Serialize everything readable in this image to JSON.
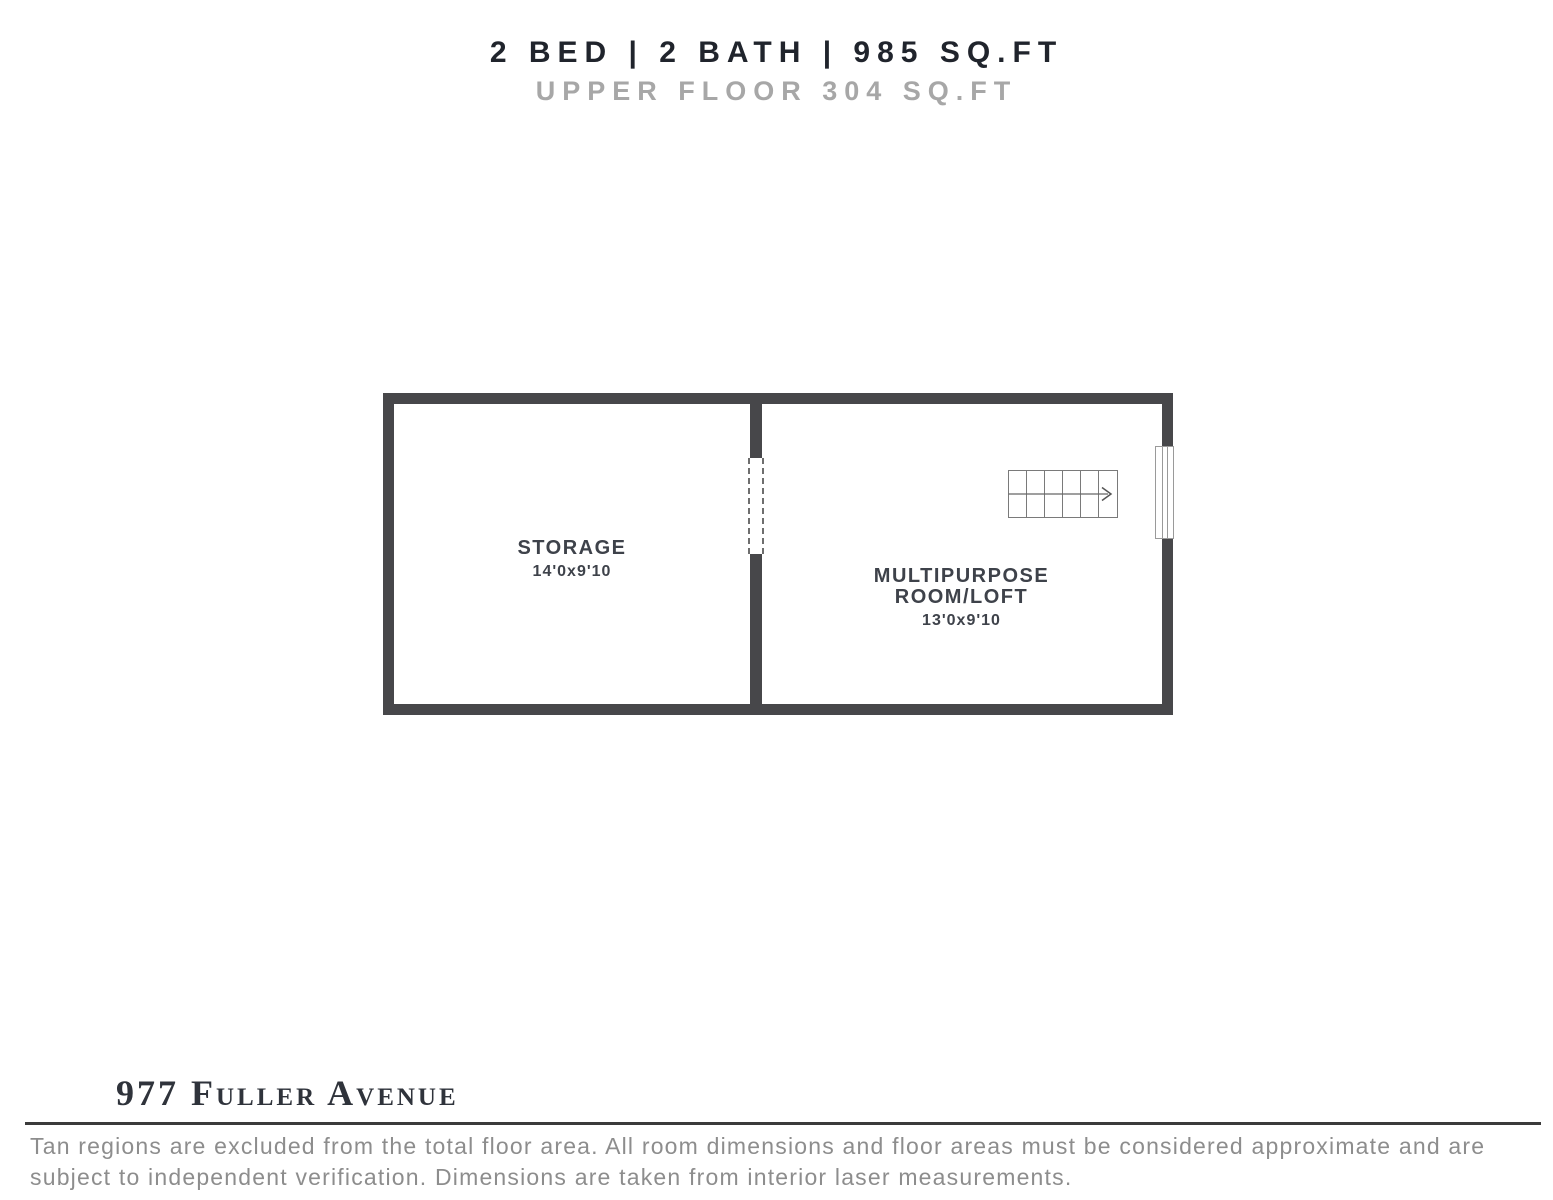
{
  "header": {
    "title": "2 BED | 2 BATH | 985 SQ.FT",
    "subtitle": "UPPER FLOOR 304 SQ.FT"
  },
  "floorplan": {
    "rooms": [
      {
        "label_lines": [
          "STORAGE"
        ],
        "dimensions": "14'0x9'10"
      },
      {
        "label_lines": [
          "MULTIPURPOSE",
          "ROOM/LOFT"
        ],
        "dimensions": "13'0x9'10"
      }
    ],
    "features": [
      "stairs-with-up-arrow",
      "window-on-right-wall",
      "dashed-opening-between-rooms"
    ]
  },
  "footer": {
    "address": "977 Fuller Avenue",
    "disclaimer": "Tan regions are excluded from the total floor area. All room dimensions and floor areas must be considered approximate and are subject to independent verification. Dimensions are taken from interior laser measurements."
  },
  "colors": {
    "wall": "#47474a",
    "title_text": "#20242c",
    "subtitle_text": "#a7a7a7",
    "room_label_text": "#3e424a",
    "address_text": "#2f333b",
    "disclaimer_text": "#8d8d8d",
    "stairs_line": "#7a7a7a",
    "window_outline": "#9a9a9a"
  }
}
